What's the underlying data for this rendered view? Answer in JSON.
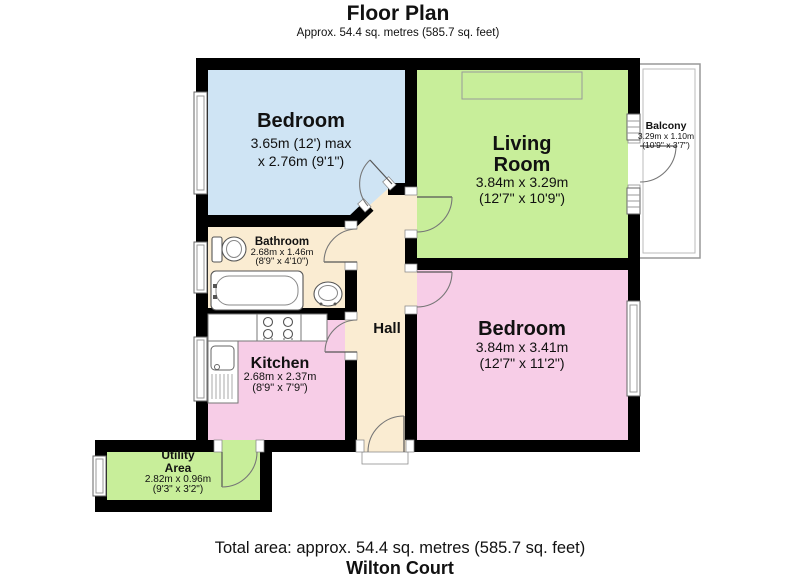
{
  "header": {
    "title": "Floor Plan",
    "subtitle": "Approx. 54.4 sq. metres (585.7 sq. feet)"
  },
  "footer": {
    "total_area": "Total area: approx. 54.4 sq. metres (585.7 sq. feet)",
    "property_name": "Wilton Court"
  },
  "rooms": {
    "bedroom1": {
      "name": "Bedroom",
      "dim1": "3.65m (12') max",
      "dim2": "x 2.76m (9'1\")"
    },
    "living": {
      "name1": "Living",
      "name2": "Room",
      "dim1": "3.84m x 3.29m",
      "dim2": "(12'7\" x 10'9\")"
    },
    "balcony": {
      "name": "Balcony",
      "dim1": "3.29m x 1.10m",
      "dim2": "(10'9\" x 3'7\")"
    },
    "bathroom": {
      "name": "Bathroom",
      "dim1": "2.68m x 1.46m",
      "dim2": "(8'9\" x 4'10\")"
    },
    "bedroom2": {
      "name": "Bedroom",
      "dim1": "3.84m x 3.41m",
      "dim2": "(12'7\" x 11'2\")"
    },
    "kitchen": {
      "name": "Kitchen",
      "dim1": "2.68m x 2.37m",
      "dim2": "(8'9\" x 7'9\")"
    },
    "hall": {
      "name": "Hall"
    },
    "utility": {
      "name1": "Utility",
      "name2": "Area",
      "dim1": "2.82m x 0.96m",
      "dim2": "(9'3\" x 3'2\")"
    }
  },
  "colors": {
    "wall": "#000000",
    "room_blue": "#cfe4f4",
    "room_green": "#c8ee9a",
    "room_pink": "#f7cde7",
    "room_cream": "#faecd2",
    "white": "#ffffff"
  }
}
